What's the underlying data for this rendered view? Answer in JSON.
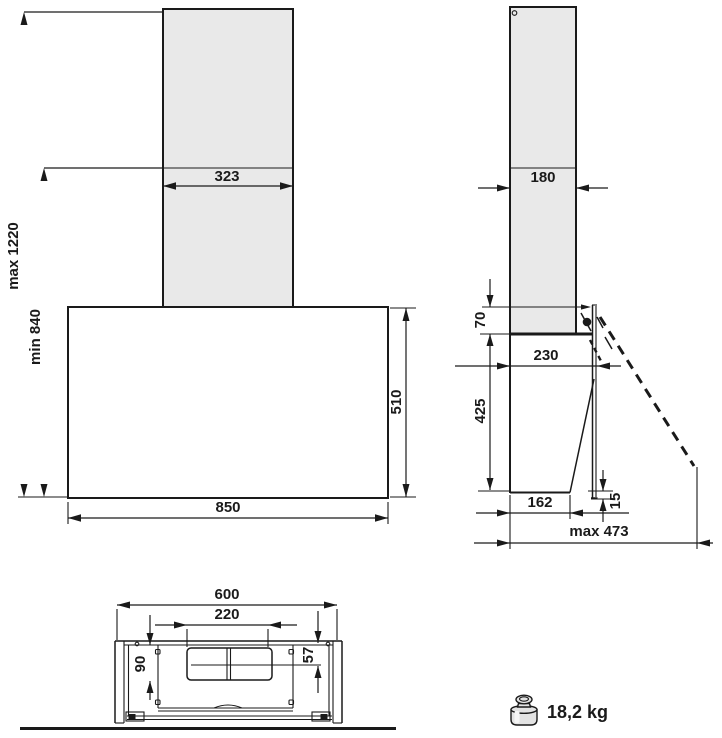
{
  "drawing": {
    "title": "cooker-hood-dimension-drawing",
    "front_view": {
      "chimney_width": "323",
      "mount_height_max": "max 1220",
      "mount_height_min": "min 840",
      "body_height": "510",
      "body_width": "850"
    },
    "side_view": {
      "chimney_depth": "180",
      "panel_top_offset": "70",
      "body_depth": "230",
      "body_height": "425",
      "bottom_depth": "162",
      "panel_bottom_offset": "15",
      "open_depth_max": "max 473"
    },
    "bottom_view": {
      "body_width": "600",
      "duct_width": "220",
      "duct_offset_left": "90",
      "duct_offset_right": "57"
    },
    "weight": {
      "label": "18,2 kg"
    },
    "colors": {
      "line": "#1a1a1a",
      "chimney_fill": "#e9e9e9",
      "background": "#ffffff"
    }
  }
}
